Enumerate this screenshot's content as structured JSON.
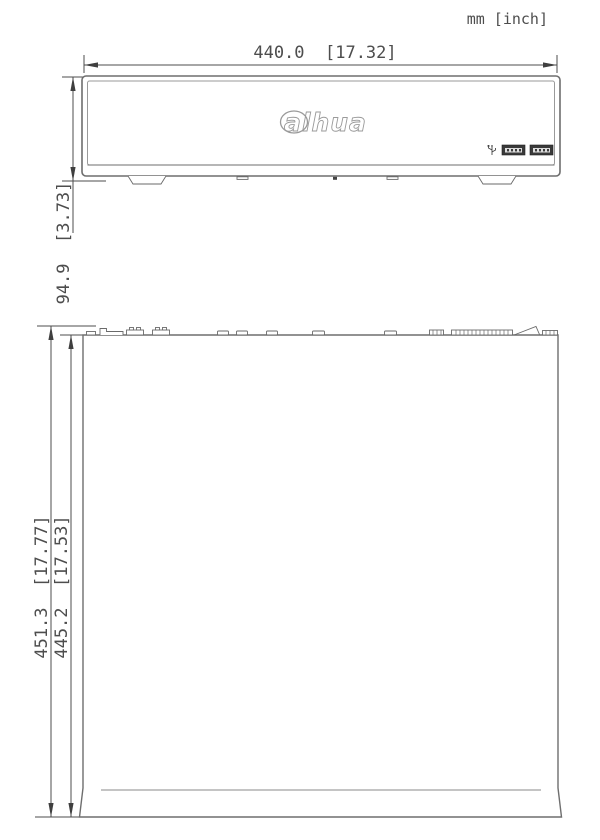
{
  "page": {
    "units_label": "mm [inch]"
  },
  "front_view": {
    "width_dim_label": "440.0  [17.32]",
    "height_dim_label": "94.9  [3.73]",
    "logo_text": "alhua",
    "usb_port_count": 2
  },
  "top_view": {
    "outer_depth_dim_label": "451.3  [17.77]",
    "inner_depth_dim_label": "445.2  [17.53]"
  },
  "colors": {
    "line": "#4d4d4d",
    "case_outline": "#6e6e6e",
    "light_line": "#9a9a9a",
    "port_fill": "#3a3a3a",
    "background": "#ffffff"
  }
}
